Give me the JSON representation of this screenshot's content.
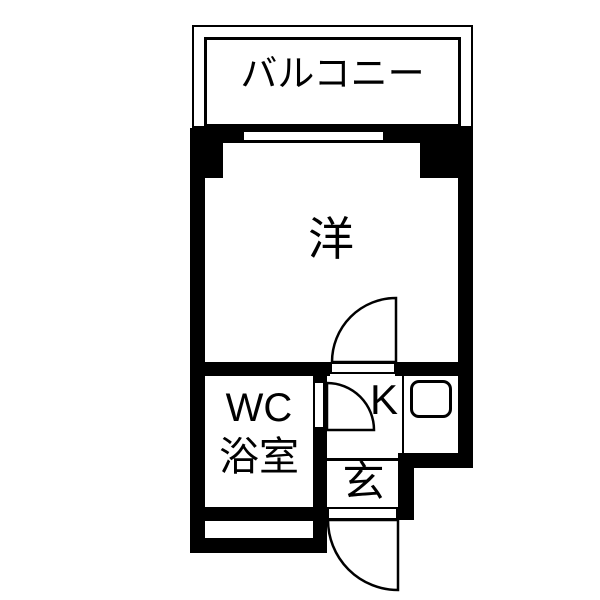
{
  "plan": {
    "type": "apartment-floorplan",
    "colors": {
      "wall": "#000000",
      "floor": "#ffffff"
    },
    "rooms": {
      "balcony": {
        "label": "バルコニー"
      },
      "western": {
        "label": "洋"
      },
      "wc_bath": {
        "line1": "WC",
        "line2": "浴室"
      },
      "kitchen": {
        "label": "K"
      },
      "entrance": {
        "label": "玄"
      }
    },
    "fixtures": {
      "sink": "kitchen-sink",
      "doors": [
        "western-kitchen-door",
        "wc-door",
        "entrance-door"
      ],
      "window": "balcony-window"
    }
  }
}
